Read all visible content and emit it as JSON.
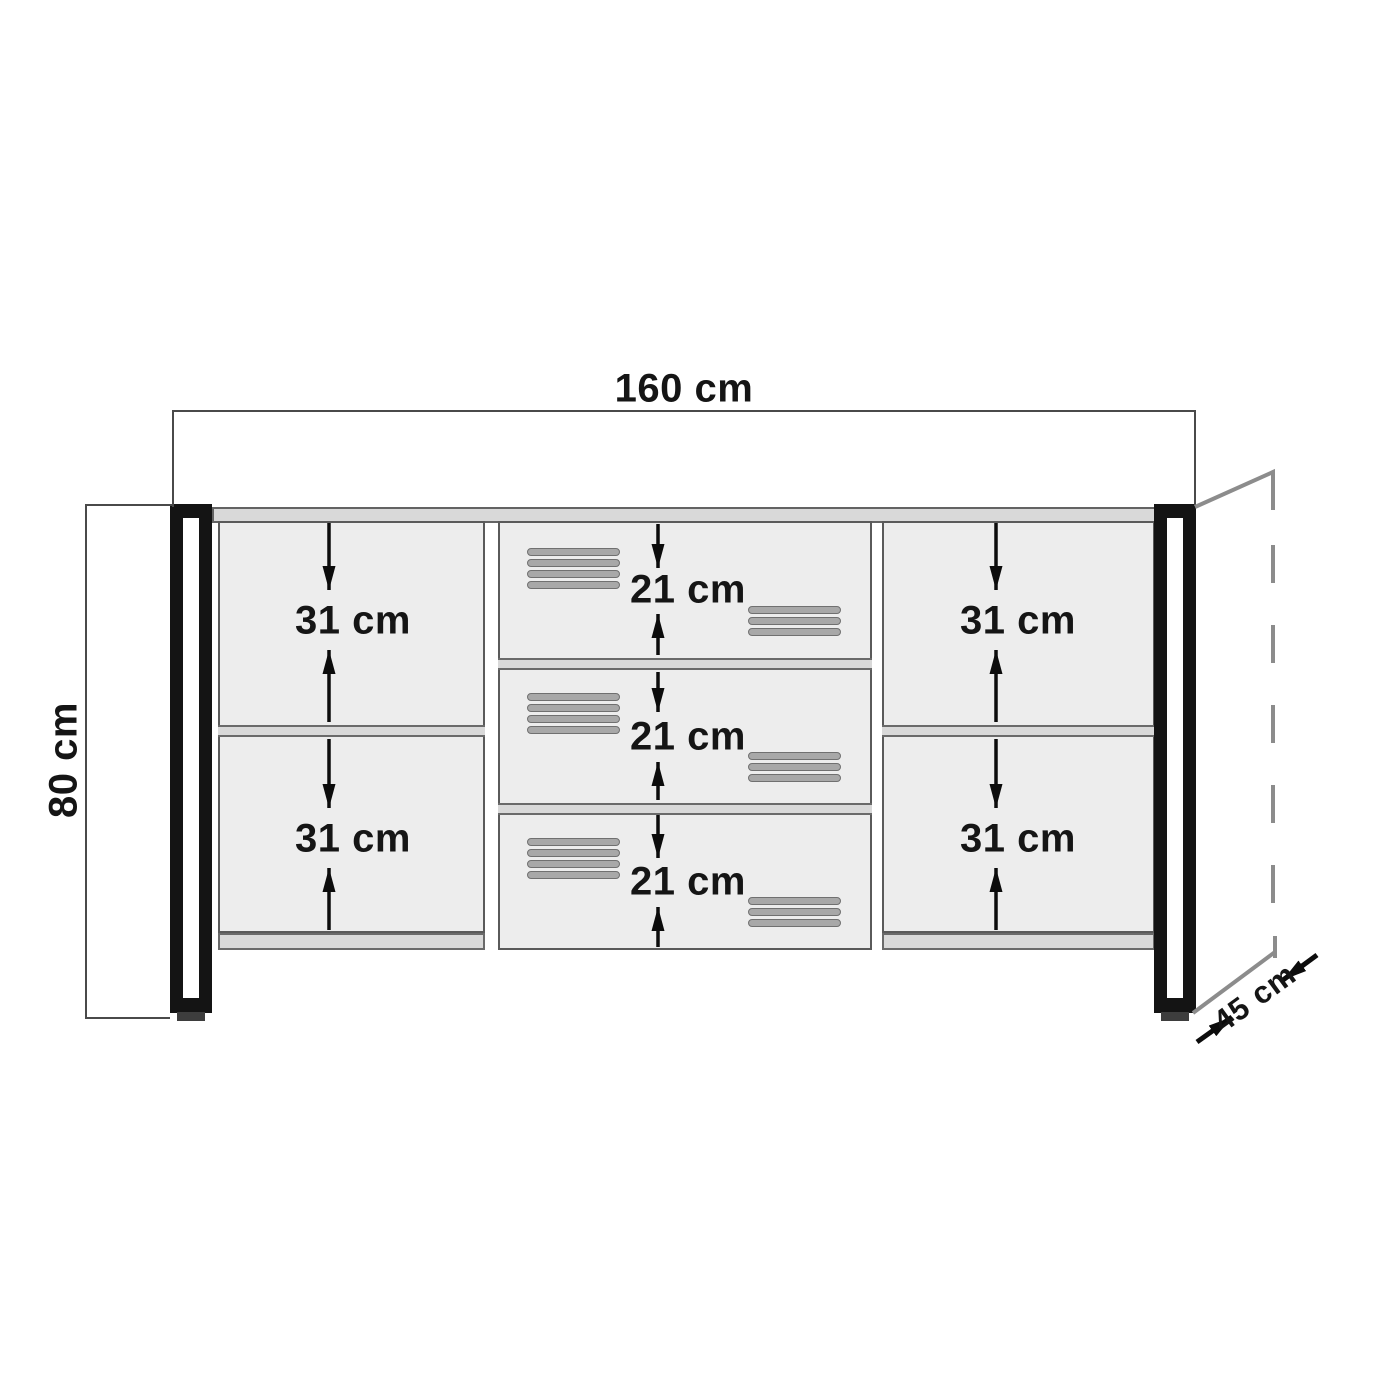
{
  "diagram": {
    "dimensions": {
      "width": "160 cm",
      "height": "80 cm",
      "depth": "45 cm"
    },
    "compartments": {
      "left_cells": [
        "31 cm",
        "31 cm"
      ],
      "middle_drawers": [
        "21 cm",
        "21 cm",
        "21 cm"
      ],
      "right_cells": [
        "31 cm",
        "31 cm"
      ]
    },
    "colors": {
      "background": "#ffffff",
      "dimension_line": "#4a4a4a",
      "depth_guide": "#8c8c8c",
      "panel_fill": "#d9d9d9",
      "compartment_fill": "#ededed",
      "leg": "#141414",
      "slat": "#a8a8a8",
      "label_text": "#151515"
    }
  }
}
